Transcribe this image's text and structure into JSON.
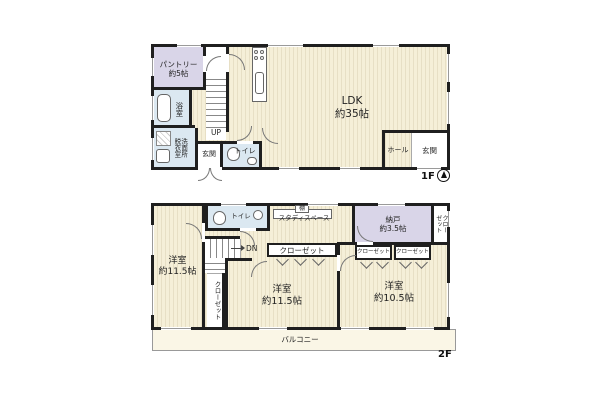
{
  "colors": {
    "wood": "#f5efd8",
    "stripe": "#e7dfc5",
    "lavender": "#d9d5e8",
    "blue": "#dbe8f1",
    "wall": "#1f1f1f",
    "balcony": "#faf6e6"
  },
  "f1": {
    "floor_label": "1F",
    "pantry": "パントリー\n約5帖",
    "bath": "浴室",
    "washroom": "洗面所\n脱衣室",
    "up": "UP",
    "genkan_left": "玄関",
    "toilet": "トイレ",
    "ldk": "LDK\n約35帖",
    "hall": "ホール",
    "genkan_right": "玄関"
  },
  "f2": {
    "floor_label": "2F",
    "toilet": "トイレ",
    "shelf": "棚",
    "study": "スタディスペース",
    "storage": "納戸\n約3.5帖",
    "closet_right_vertical": "クロー\nゼット",
    "dn": "DN",
    "closet_middle_top": "クローゼット",
    "closet_r1": "クローゼット",
    "closet_r2": "クローゼット",
    "closet_left_vertical": "クローゼット",
    "room_left": "洋室\n約11.5帖",
    "room_middle": "洋室\n約11.5帖",
    "room_right": "洋室\n約10.5帖",
    "balcony": "バルコニー"
  }
}
